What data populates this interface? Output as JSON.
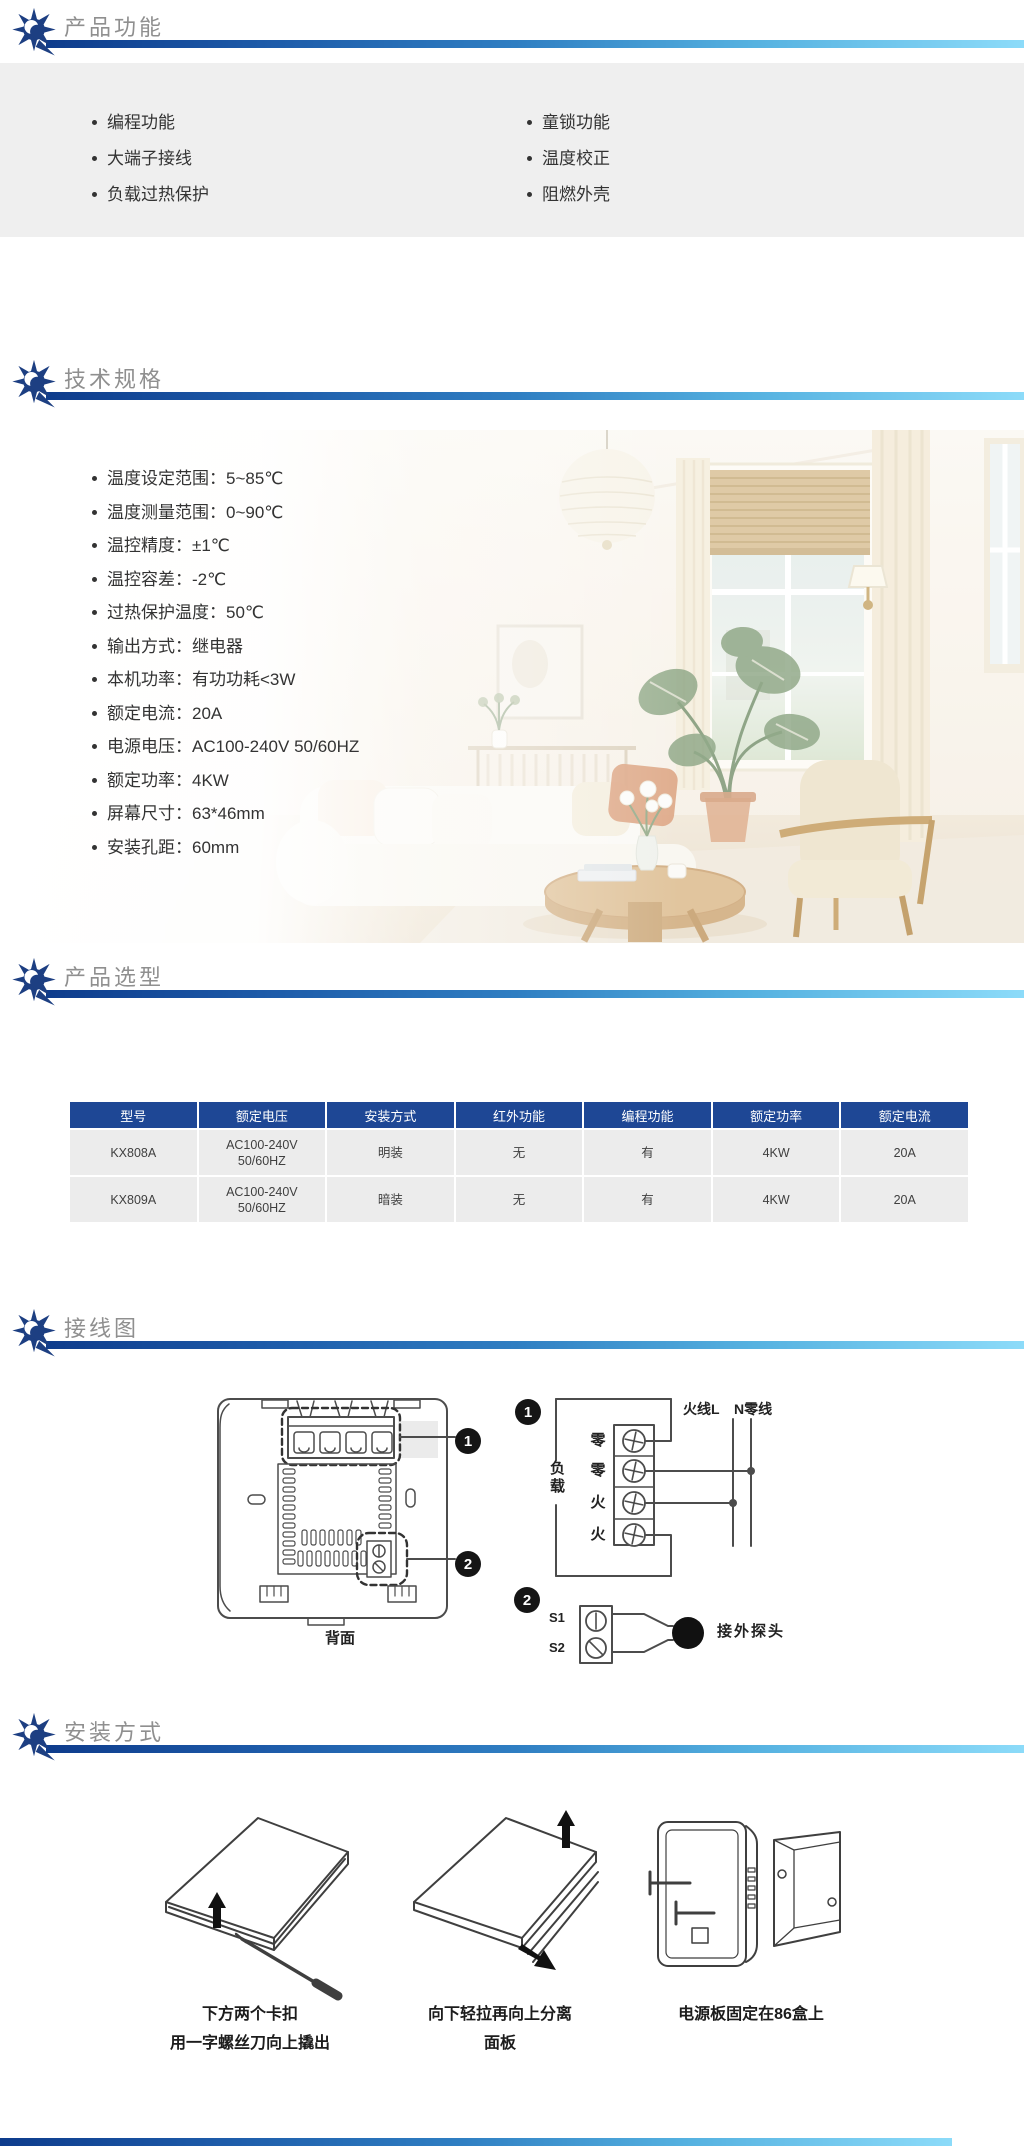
{
  "theme": {
    "bar_gradient_start": "#0e3c8c",
    "bar_gradient_end": "#8cdbf9",
    "section_title_color": "#8f8f8f",
    "brand_icon_color": "#1d3f82",
    "body_text_color": "#333333",
    "table_header_bg": "#1e4795",
    "table_row_bg": "#ececec",
    "feature_panel_bg": "#efefef"
  },
  "icons": {
    "brand": "gear-sun"
  },
  "sections": {
    "features": {
      "title": "产品功能",
      "items_left": [
        "编程功能",
        "大端子接线",
        "负载过热保护"
      ],
      "items_right": [
        "童锁功能",
        "温度校正",
        "阻燃外壳"
      ]
    },
    "specs": {
      "title": "技术规格",
      "items": [
        "温度设定范围：5~85℃",
        "温度测量范围：0~90℃",
        "温控精度：±1℃",
        "温控容差：-2℃",
        "过热保护温度：50℃",
        "输出方式：继电器",
        "本机功率：有功功耗<3W",
        "额定电流：20A",
        "电源电压：AC100-240V 50/60HZ",
        "额定功率：4KW",
        "屏幕尺寸：63*46mm",
        "安装孔距：60mm"
      ]
    },
    "selection": {
      "title": "产品选型",
      "table": {
        "headers": [
          "型号",
          "额定电压",
          "安装方式",
          "红外功能",
          "编程功能",
          "额定功率",
          "额定电流"
        ],
        "rows": [
          [
            "KX808A",
            "AC100-240V 50/60HZ",
            "明装",
            "无",
            "有",
            "4KW",
            "20A"
          ],
          [
            "KX809A",
            "AC100-240V 50/60HZ",
            "暗装",
            "无",
            "有",
            "4KW",
            "20A"
          ]
        ]
      }
    },
    "wiring": {
      "title": "接线图",
      "back_label": "背面",
      "badge1": "1",
      "badge2": "2",
      "load_label": "负载",
      "terminals": [
        "零",
        "零",
        "火",
        "火"
      ],
      "live_label": "火线L",
      "neutral_label": "N零线",
      "s1": "S1",
      "s2": "S2",
      "probe_label": "接外探头"
    },
    "installation": {
      "title": "安装方式",
      "steps": [
        {
          "line1": "下方两个卡扣",
          "line2": "用一字螺丝刀向上撬出"
        },
        {
          "line1": "向下轻拉再向上分离",
          "line2": "面板"
        },
        {
          "line1": "电源板固定在86盒上",
          "line2": ""
        }
      ]
    }
  }
}
